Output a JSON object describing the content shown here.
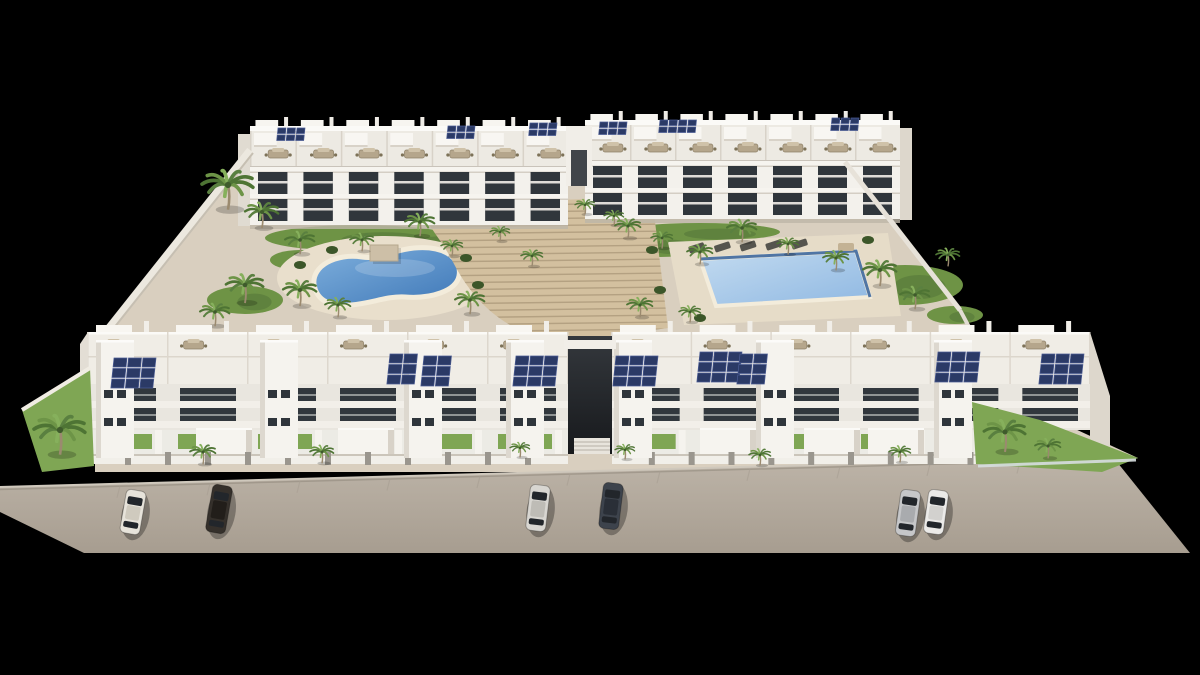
{
  "image": {
    "type": "architectural-3d-render",
    "alt": "Aerial 3D render of a white apartment complex with two pools, gardens, palm trees, rooftop solar panels and six parked cars, on a black background",
    "background": "#000000"
  },
  "palette": {
    "building_white": "#f3f1ec",
    "building_shade": "#e9e6df",
    "building_side": "#ddd7cc",
    "window_dark": "#30363c",
    "solar_panel": "#2b3a66",
    "solar_frame": "#4b5c94",
    "site_ground": "#d9cfbf",
    "deck": "#e9dfcc",
    "grass": "#6e9345",
    "grass_bright": "#7fa654",
    "stairs": "#d3c09f",
    "stairs_line": "#b19e7f",
    "road_top": "#bdb4a8",
    "road_bottom": "#a79d90",
    "pool_left_water": "#3f78b8",
    "pool_right_water": "#9fc2e6",
    "pool_border": "#33609a",
    "pool_rim": "#f3ecdb",
    "wall_white": "#ece8df",
    "post_gray": "#9a968e",
    "furniture_tan": "#b5a68c"
  },
  "site": {
    "polygon": [
      [
        248,
        150
      ],
      [
        845,
        160
      ],
      [
        962,
        312
      ],
      [
        1008,
        398
      ],
      [
        1138,
        458
      ],
      [
        1100,
        472
      ],
      [
        95,
        472
      ],
      [
        95,
        345
      ]
    ]
  },
  "road": {
    "polygon": [
      [
        0,
        487
      ],
      [
        1113,
        457
      ],
      [
        1190,
        553
      ],
      [
        84,
        553
      ],
      [
        0,
        512
      ]
    ],
    "curb_from": [
      0,
      487
    ],
    "curb_to": [
      1113,
      457
    ],
    "seam_step": 90
  },
  "rear_buildings": [
    {
      "name": "rear-left-building",
      "x0": 250,
      "x1": 568,
      "ytop": 126,
      "units": 7,
      "face": "left"
    },
    {
      "name": "rear-right-building",
      "x0": 585,
      "x1": 900,
      "ytop": 120,
      "units": 7,
      "face": "right"
    }
  ],
  "rear_gap": {
    "x": 566,
    "y": 126,
    "w": 26,
    "h": 60,
    "slit": [
      571,
      150,
      16,
      36
    ]
  },
  "front_buildings": [
    {
      "name": "front-left-building",
      "x0": 88,
      "x1": 568,
      "ytop": 332,
      "units": 6,
      "towers": [
        96,
        260,
        404,
        506
      ],
      "garages": [
        196,
        338
      ],
      "ground_x1": 568
    },
    {
      "name": "front-right-building",
      "x0": 612,
      "x1": 1090,
      "ytop": 332,
      "units": 6,
      "towers": [
        614,
        756,
        934
      ],
      "garages": [
        700,
        804,
        868
      ],
      "ground_x1": 980
    }
  ],
  "side_faces": {
    "front_left": [
      [
        80,
        344
      ],
      [
        88,
        332
      ],
      [
        88,
        464
      ],
      [
        80,
        458
      ]
    ],
    "front_right": [
      [
        1090,
        332
      ],
      [
        1110,
        396
      ],
      [
        1110,
        462
      ],
      [
        1090,
        464
      ]
    ]
  },
  "passage": {
    "x": 568,
    "y": 336,
    "w": 44,
    "h": 118,
    "bridge": [
      564,
      340,
      52,
      9
    ],
    "steps": [
      574,
      438,
      36,
      16
    ]
  },
  "pools": {
    "left": {
      "name": "kidney-pool-left",
      "deck": {
        "cx": 385,
        "cy": 278,
        "rx": 108,
        "ry": 42
      },
      "path": "M 314 284 C 312 266 336 253 362 257 C 380 260 392 250 414 248 C 448 245 462 261 459 276 C 456 291 431 299 405 297 C 387 296 373 303 351 305 C 326 307 316 298 314 284 Z",
      "highlight": {
        "cx": 395,
        "cy": 268,
        "rx": 40,
        "ry": 9
      }
    },
    "right": {
      "name": "rectangular-pool-right",
      "deck_polygon": [
        [
          668,
          242
        ],
        [
          888,
          233
        ],
        [
          901,
          316
        ],
        [
          684,
          325
        ]
      ],
      "water_polygon": [
        [
          700,
          259
        ],
        [
          856,
          251
        ],
        [
          870,
          297
        ],
        [
          716,
          306
        ]
      ],
      "border_path": "M 700 259 L 856 251 L 870 297"
    }
  },
  "stairs": {
    "fan_path": "M 430 226 C 452 206 500 198 556 200 L 652 197 L 668 328 L 566 342 C 508 337 474 302 454 264 C 446 248 438 238 430 226 Z",
    "line_y0": 206,
    "line_y1": 338,
    "line_step": 7,
    "line_x0": 426,
    "line_x1": 674
  },
  "pergola": {
    "x": 370,
    "y": 245,
    "w": 28,
    "h": 16
  },
  "loungers": {
    "xs": [
      688,
      714,
      740,
      766,
      792
    ],
    "y": 247,
    "tan": [
      838,
      243
    ]
  },
  "grass_ellipses": [
    [
      360,
      238,
      95,
      13
    ],
    [
      245,
      300,
      38,
      14
    ],
    [
      300,
      260,
      30,
      10
    ],
    [
      430,
      240,
      70,
      10
    ],
    [
      660,
      245,
      48,
      12
    ],
    [
      905,
      285,
      58,
      20
    ],
    [
      955,
      315,
      28,
      9
    ],
    [
      700,
      232,
      80,
      9
    ],
    [
      610,
      305,
      36,
      9
    ]
  ],
  "grass_polygons": [
    {
      "name": "front-left-corner-garden",
      "points": [
        [
          22,
          410
        ],
        [
          90,
          368
        ],
        [
          94,
          466
        ],
        [
          42,
          472
        ]
      ]
    },
    {
      "name": "front-right-corner-garden",
      "points": [
        [
          972,
          402
        ],
        [
          1040,
          420
        ],
        [
          1138,
          458
        ],
        [
          1102,
          472
        ],
        [
          976,
          464
        ]
      ]
    }
  ],
  "shrubs": [
    [
      466,
      258
    ],
    [
      478,
      285
    ],
    [
      652,
      250
    ],
    [
      660,
      290
    ],
    [
      700,
      318
    ],
    [
      868,
      240
    ],
    [
      332,
      250
    ],
    [
      300,
      265
    ],
    [
      35,
      425
    ],
    [
      70,
      395
    ],
    [
      990,
      415
    ],
    [
      1095,
      452
    ]
  ],
  "fences": {
    "left_corner": [
      [
        22,
        410
      ],
      [
        90,
        368
      ]
    ],
    "right_glass": [
      [
        978,
        466
      ],
      [
        1136,
        460
      ]
    ]
  },
  "walls": {
    "left": [
      [
        250,
        150
      ],
      [
        95,
        345
      ]
    ],
    "right": [
      [
        845,
        162
      ],
      [
        960,
        310
      ]
    ],
    "right_lower": [
      [
        960,
        310
      ],
      [
        1005,
        395
      ]
    ]
  },
  "palms_garden": [
    [
      228,
      185,
      26
    ],
    [
      262,
      212,
      17
    ],
    [
      300,
      240,
      15
    ],
    [
      245,
      285,
      19
    ],
    [
      215,
      312,
      15
    ],
    [
      300,
      290,
      17
    ],
    [
      338,
      305,
      13
    ],
    [
      362,
      240,
      12
    ],
    [
      420,
      222,
      15
    ],
    [
      452,
      246,
      11
    ],
    [
      470,
      300,
      15
    ],
    [
      500,
      232,
      10
    ],
    [
      532,
      256,
      11
    ],
    [
      585,
      205,
      10
    ],
    [
      614,
      216,
      10
    ],
    [
      628,
      226,
      13
    ],
    [
      662,
      238,
      11
    ],
    [
      700,
      252,
      13
    ],
    [
      742,
      228,
      15
    ],
    [
      788,
      244,
      11
    ],
    [
      836,
      258,
      13
    ],
    [
      880,
      270,
      17
    ],
    [
      915,
      295,
      15
    ],
    [
      948,
      255,
      12
    ],
    [
      640,
      305,
      13
    ],
    [
      690,
      312,
      11
    ]
  ],
  "palms_street": [
    [
      60,
      430,
      26
    ],
    [
      203,
      452,
      13
    ],
    [
      322,
      452,
      12
    ],
    [
      520,
      448,
      10
    ],
    [
      625,
      450,
      10
    ],
    [
      760,
      455,
      11
    ],
    [
      900,
      452,
      11
    ],
    [
      1005,
      432,
      21
    ],
    [
      1048,
      446,
      13
    ]
  ],
  "solar_rear": [
    {
      "x": 278,
      "y": 128,
      "c": 3,
      "r": 2
    },
    {
      "x": 448,
      "y": 126,
      "c": 3,
      "r": 2
    },
    {
      "x": 530,
      "y": 123,
      "c": 3,
      "r": 2
    },
    {
      "x": 600,
      "y": 122,
      "c": 3,
      "r": 2
    },
    {
      "x": 660,
      "y": 120,
      "c": 4,
      "r": 2
    },
    {
      "x": 832,
      "y": 118,
      "c": 3,
      "r": 2
    }
  ],
  "solar_front": [
    {
      "x": 114,
      "y": 358,
      "c": 3,
      "r": 3
    },
    {
      "x": 390,
      "y": 354,
      "c": 2,
      "r": 3
    },
    {
      "x": 424,
      "y": 356,
      "c": 2,
      "r": 3
    },
    {
      "x": 516,
      "y": 356,
      "c": 3,
      "r": 3
    },
    {
      "x": 616,
      "y": 356,
      "c": 3,
      "r": 3
    },
    {
      "x": 700,
      "y": 352,
      "c": 3,
      "r": 3
    },
    {
      "x": 740,
      "y": 354,
      "c": 2,
      "r": 3
    },
    {
      "x": 938,
      "y": 352,
      "c": 3,
      "r": 3
    },
    {
      "x": 1042,
      "y": 354,
      "c": 3,
      "r": 3
    }
  ],
  "cars": [
    {
      "name": "white-car-left",
      "x": 133,
      "y": 512,
      "rot": 10,
      "len": 44,
      "color": "#e7e3da",
      "roof": "#cfcabe"
    },
    {
      "name": "dark-car-left",
      "x": 219,
      "y": 509,
      "rot": 10,
      "len": 48,
      "color": "#35302b",
      "roof": "#221e1a"
    },
    {
      "name": "silver-car-center",
      "x": 538,
      "y": 508,
      "rot": 7,
      "len": 46,
      "color": "#d8d6d1",
      "roof": "#bebcb6"
    },
    {
      "name": "dark-car-center",
      "x": 611,
      "y": 506,
      "rot": 7,
      "len": 46,
      "color": "#3d434c",
      "roof": "#2a2f37"
    },
    {
      "name": "silver-car-right",
      "x": 908,
      "y": 513,
      "rot": 8,
      "len": 46,
      "color": "#c6c7c9",
      "roof": "#a9abae"
    },
    {
      "name": "white-car-right",
      "x": 936,
      "y": 512,
      "rot": 8,
      "len": 44,
      "color": "#ebeae8",
      "roof": "#d2d1ce"
    }
  ]
}
